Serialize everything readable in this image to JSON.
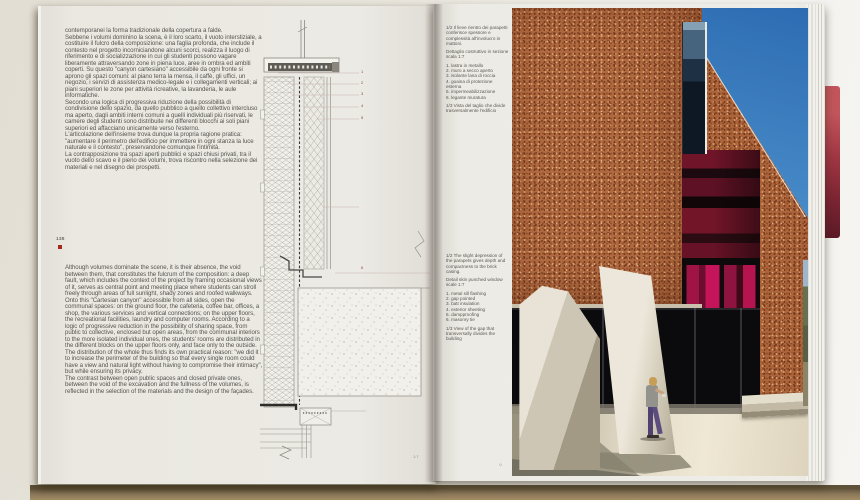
{
  "page_left": {
    "number": "138",
    "col_it": [
      "contemporanei la forma tradizionale della copertura a falde.",
      "Sebbene i volumi dominino la scena, è il loro scarto, il vuoto interstiziale, a costituire il fulcro della composizione: una faglia profonda, che include il contesto nel progetto incorniciandone alcuni scorci, realizza il luogo di riferimento e di socializzazione in cui gli studenti possono vagare liberamente attraversando zone in piena luce, aree in ombra ed ambiti coperti. Su questo \"canyon cartesiano\" accessibile da ogni fronte si aprono gli spazi comuni: al piano terra la mensa, il caffè, gli uffici, un negozio, i servizi di assistenza medico-legale e i collegamenti verticali; ai piani superiori le zone per attività ricreative, la lavanderia, le aule informatiche.",
      "Secondo una logica di progressiva riduzione della possibilità di condivisione dello spazio, da quello pubblico a quello collettivo intercluso ma aperto, dagli ambiti interni comuni a quelli individuali più riservati, le camere degli studenti sono distribuite nei differenti blocchi ai soli piani superiori ed affacciano unicamente verso l'esterno.",
      "L'articolazione dell'insieme trova dunque la propria ragione pratica: \"aumentare il perimetro dell'edificio per immettere in ogni stanza la luce naturale e il contesto\", preservandone comunque l'intimità.",
      "La contrapposizione tra spazi aperti pubblici e spazi chiusi privati, tra il vuoto dello scavo e il pieno dei volumi, trova riscontro nella selezione dei materiali e nel disegno dei prospetti."
    ],
    "col_en": [
      "Although volumes dominate the scene, it is their absence, the void between them, that constitutes the fulcrum of the composition: a deep fault, which includes the context of the project by framing occasional views of it, serves as central point and meeting place where students can stroll freely through areas of full sunlight, shady zones and roofed walkways. Onto this \"Cartesian canyon\" accessible from all sides, open the communal spaces: on the ground floor, the cafeteria, coffee bar, offices, a shop, the various services and vertical connections; on the upper floors, the recreational facilities, laundry and computer rooms. According to a logic of progressive reduction in the possibility of sharing space, from public to collective, enclosed but open areas, from the communal interiors to the more isolated individual ones, the students' rooms are distributed in the different blocks on the upper floors only, and face only to the outside. The distribution of the whole thus finds its own practical reason: \"we did it to increase the perimeter of the building so that every single room could have a view and natural light without having to compromise their intimacy\", but while ensuring its privacy.",
      "The contrast between open public spaces and closed private ones, between the void of the excavation and the fullness of the volumes, is reflected in the selection of the materials and the design of the façades."
    ],
    "drawing": {
      "callouts": [
        "1",
        "2",
        "3",
        "4",
        "5",
        "6"
      ],
      "scale_note": "1:7"
    }
  },
  "page_right": {
    "caption_it": {
      "intro": "1/2 Il lieve rientro dei parapetti conferisce spessore e complessità all'involucro in mattoni.",
      "subtitle": "Dettaglio costruttivo in sezione scala 1:7",
      "items": [
        "1. lastra in metallo",
        "2. muro a secco aperto",
        "3. isolante lana di roccia",
        "4. guaina di protezione esterna",
        "5. impermeabilizzazione",
        "6. legante muratura"
      ],
      "outro": "1/3 Vista del taglio che divide trasversalmente l'edificio"
    },
    "caption_en": {
      "intro": "1/2 The slight depression of the parapets gives depth and compactness to the brick casing.",
      "subtitle": "Detail skin punched window scale 1:7",
      "items": [
        "1. metal sill flashing",
        "2. gap pointed",
        "3. batt insulation",
        "4. exterior sheeting",
        "5. dampproofing",
        "6. masonry tie"
      ],
      "outro": "1/3 View of the gap that transversally divides the building"
    },
    "photo_credit": "©"
  }
}
